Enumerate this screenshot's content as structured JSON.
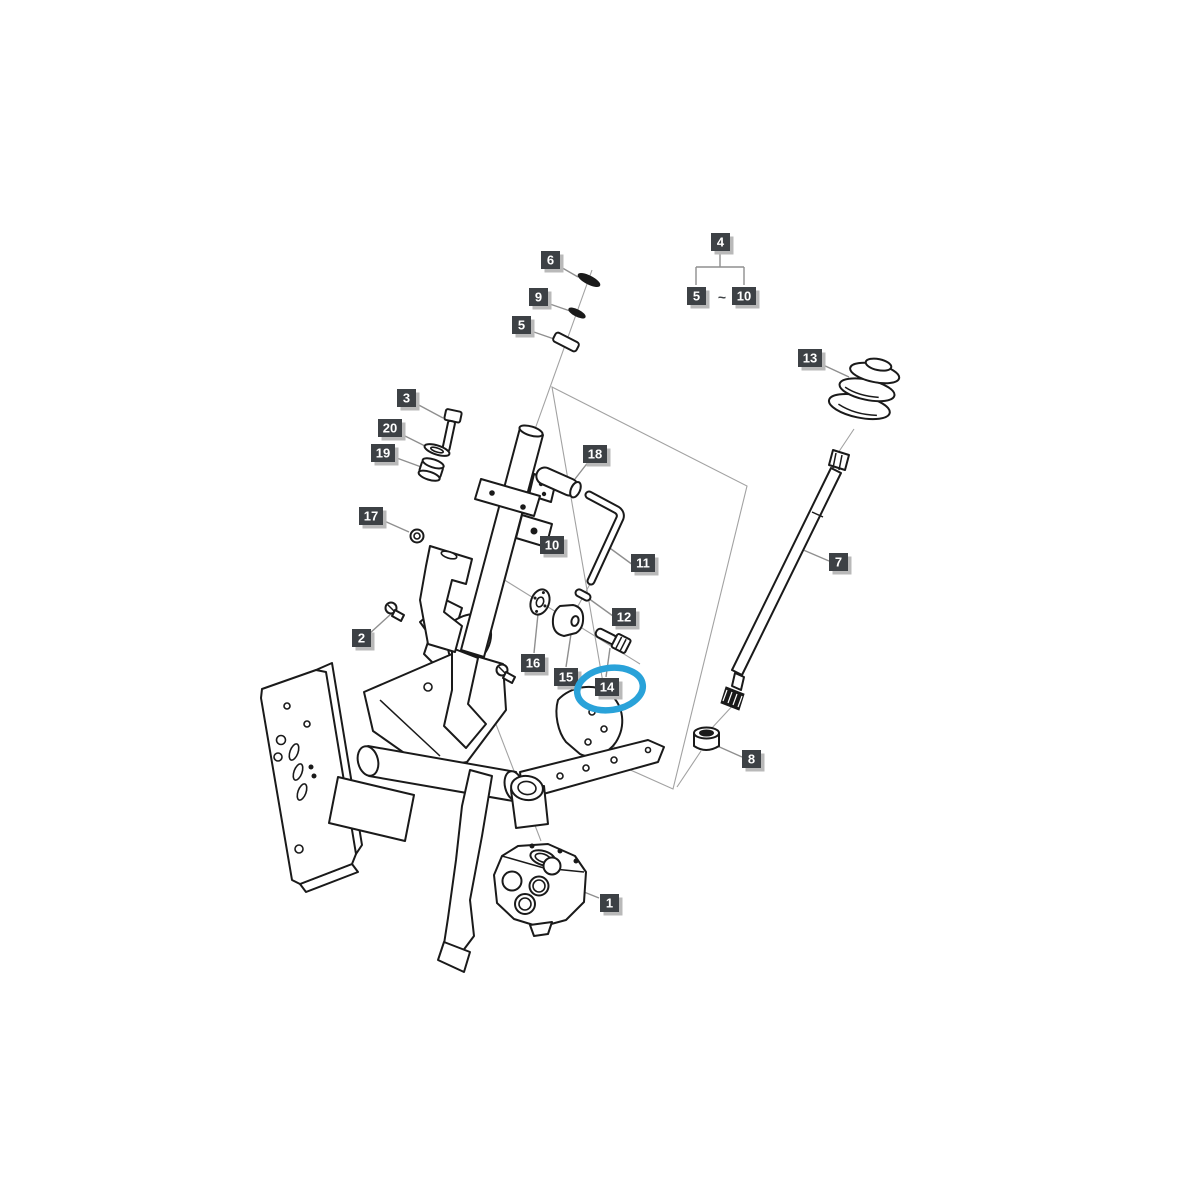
{
  "diagram": {
    "type": "exploded-parts-diagram",
    "subject": "steering column assembly",
    "background_color": "#ffffff",
    "line_color": "#1a1a1a",
    "leader_color": "#8f8f8f",
    "label_bg_color": "#3d4145",
    "label_text_color": "#ffffff",
    "label_shadow_color": "#b9b9b9",
    "highlight_color": "#29a2d9",
    "highlighted_label": "14",
    "group_note": {
      "parent": "4",
      "from": "5",
      "separator": "~",
      "to": "10"
    },
    "labels": {
      "l1": "1",
      "l2": "2",
      "l3": "3",
      "l4": "4",
      "l5": "5",
      "l6": "6",
      "l7": "7",
      "l8": "8",
      "l9": "9",
      "l10": "10",
      "l11": "11",
      "l12": "12",
      "l13": "13",
      "l14": "14",
      "l15": "15",
      "l16": "16",
      "l17": "17",
      "l18": "18",
      "l19": "19",
      "l20": "20"
    },
    "parts": [
      {
        "label": "1",
        "name": "steering-valve-unit"
      },
      {
        "label": "2",
        "name": "small-screw"
      },
      {
        "label": "3",
        "name": "bolt"
      },
      {
        "label": "4",
        "name": "group-5-to-10-subassembly"
      },
      {
        "label": "5",
        "name": "sleeve-spacer"
      },
      {
        "label": "6",
        "name": "snap-ring"
      },
      {
        "label": "7",
        "name": "steering-shaft"
      },
      {
        "label": "8",
        "name": "bushing"
      },
      {
        "label": "9",
        "name": "washer"
      },
      {
        "label": "10",
        "name": "steering-column-tube"
      },
      {
        "label": "11",
        "name": "tilt-lever-rod"
      },
      {
        "label": "12",
        "name": "pin"
      },
      {
        "label": "13",
        "name": "bellows-boot"
      },
      {
        "label": "14",
        "name": "bolt-fitting-highlighted"
      },
      {
        "label": "15",
        "name": "spacer-cylinder"
      },
      {
        "label": "16",
        "name": "plate-disc"
      },
      {
        "label": "17",
        "name": "nut"
      },
      {
        "label": "18",
        "name": "lever-grip"
      },
      {
        "label": "19",
        "name": "collar-bushing"
      },
      {
        "label": "20",
        "name": "flat-washer"
      }
    ]
  }
}
